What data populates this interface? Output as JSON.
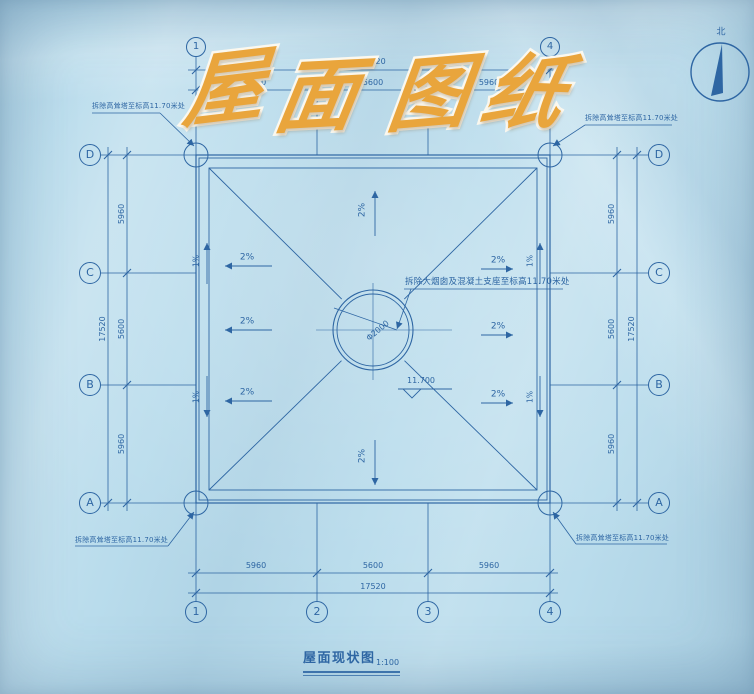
{
  "colors": {
    "paper": "#b9dcec",
    "ink": "#2e66a3",
    "title_fill": "#e9a53c",
    "title_outline": "#fbf8ef"
  },
  "title": {
    "text": "屋面图纸",
    "chars": [
      "屋",
      "面",
      "图",
      "纸"
    ]
  },
  "compass": {
    "north_label": "北"
  },
  "grid": {
    "cols": [
      "1",
      "2",
      "3",
      "4"
    ],
    "rows": [
      "D",
      "C",
      "B",
      "A"
    ]
  },
  "dims": {
    "total": "17520",
    "seg_a": "5960",
    "seg_b": "5600",
    "seg_c": "5960"
  },
  "slopes": {
    "main": "2%",
    "edge": "1%"
  },
  "annotations": {
    "corner_note": "拆除高耸塔至标高11.70米处",
    "center_note": "拆除大烟囱及混凝土支座至标高11.70米处",
    "circle_diameter": "Φ2000",
    "elevation": "11.700"
  },
  "footer": {
    "drawing_title": "屋面现状图",
    "scale": "1:100"
  }
}
